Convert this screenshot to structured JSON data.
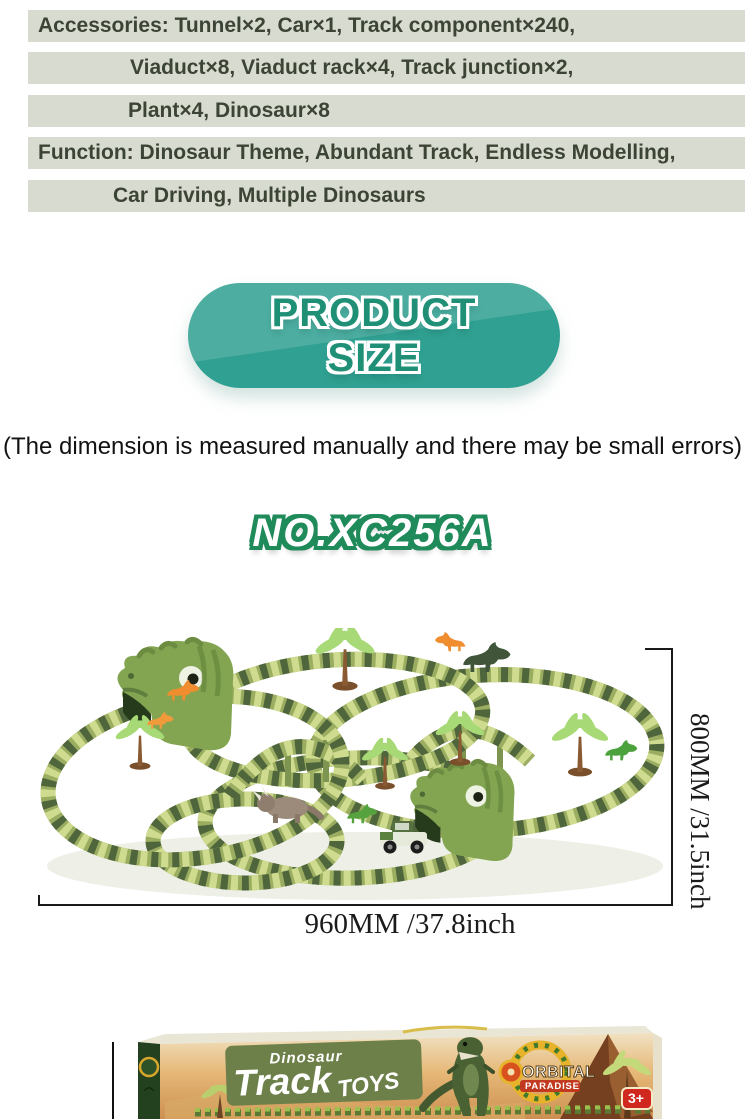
{
  "info_bars": {
    "bg_color": "#d8dcd0",
    "text_color": "#3c4535",
    "lines": [
      "Accessories: Tunnel×2, Car×1, Track component×240,",
      "Viaduct×8, Viaduct rack×4, Track junction×2,",
      "Plant×4, Dinosaur×8",
      "Function: Dinosaur Theme, Abundant Track, Endless Modelling,",
      "Car Driving, Multiple Dinosaurs"
    ]
  },
  "size_badge": {
    "line1": "PRODUCT",
    "line2": "SIZE",
    "bg_color": "#2fa091",
    "highlight_color": "#4cb3a3",
    "text_color": "#1f8f75"
  },
  "note": "(The dimension is measured manually and there may be small errors)",
  "model_no": "NO.XC256A",
  "model_no_colors": {
    "fill": "#ffffff",
    "outline": "#1f8a5a"
  },
  "dimensions": {
    "width_label": "960MM /37.8inch",
    "height_label": "800MM /31.5inch"
  },
  "track_scene": {
    "track_colors": {
      "base": "#9aad60",
      "dark": "#4f653c",
      "light": "#cfdc90"
    },
    "elements": [
      "dinosaur-head-tunnel ×2",
      "palm-tree ×5",
      "toy-dinosaurs",
      "toy-car",
      "viaduct-bridges"
    ]
  },
  "box": {
    "brand_top": "Dinosaur",
    "brand_main": "Track",
    "brand_suffix": "TOYS",
    "logo_line1": "ORBITAL",
    "logo_line2": "PARADISE",
    "age_badge": "3+"
  }
}
